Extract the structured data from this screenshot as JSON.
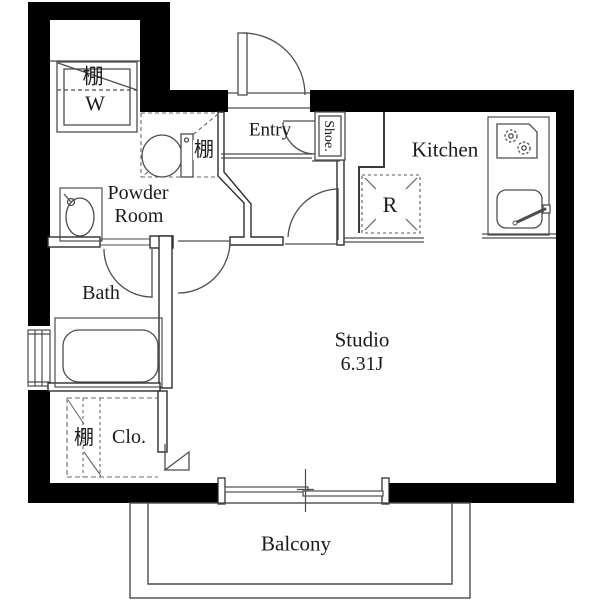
{
  "plan": {
    "title": "Studio apartment floor plan",
    "colors": {
      "wall": "#000000",
      "line": "#4d4d4d",
      "partition": "#2e2e2e",
      "text": "#1b1b1b",
      "background": "#ffffff"
    },
    "labels": {
      "shelf_washer": "棚",
      "washer": "W",
      "entry": "Entry",
      "shoe": "Shoe.",
      "kitchen": "Kitchen",
      "shelf_toilet": "棚",
      "powder_line1": "Powder",
      "powder_line2": "Room",
      "refrigerator": "R",
      "bath": "Bath",
      "studio_name": "Studio",
      "studio_size": "6.31J",
      "shelf_closet": "棚",
      "closet": "Clo.",
      "balcony": "Balcony"
    },
    "rooms": [
      {
        "name": "Entry"
      },
      {
        "name": "Powder Room"
      },
      {
        "name": "Bath"
      },
      {
        "name": "Kitchen"
      },
      {
        "name": "Studio",
        "size_tatami": "6.31J"
      },
      {
        "name": "Closet"
      },
      {
        "name": "Balcony"
      }
    ],
    "fixtures": [
      "washing-machine-pan",
      "overhead-shelf",
      "toilet",
      "wash-basin",
      "bathtub",
      "refrigerator-space",
      "gas-stove",
      "kitchen-sink",
      "shoe-cabinet",
      "entry-door",
      "sliding-glass-door",
      "window"
    ]
  }
}
